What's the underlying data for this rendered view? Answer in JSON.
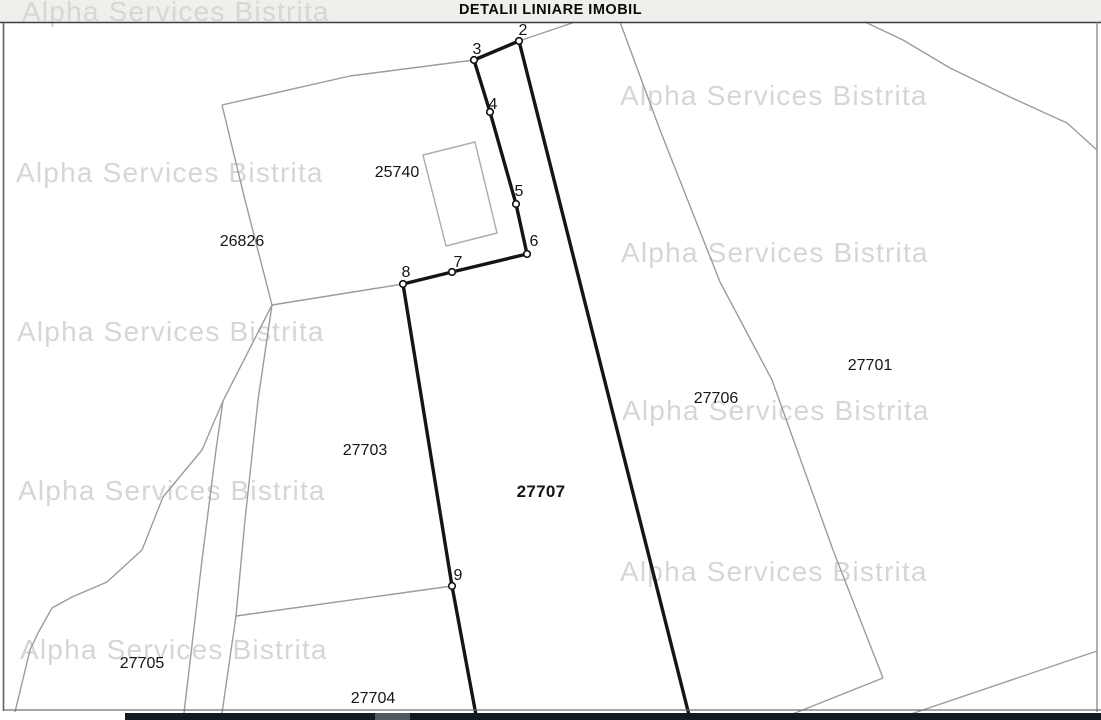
{
  "header": {
    "title": "DETALII LINIARE IMOBIL"
  },
  "watermark": {
    "text": "Alpha Services Bistrita"
  },
  "colors": {
    "header_bg": "#f1efec",
    "watermark": "#d6d6d6",
    "subject_outline": "#151515",
    "boundary": "#9c9c9c",
    "building": "#aeaeae",
    "bottom_bar": "#141a20",
    "bottom_bar_accent": "#4e5a60",
    "vertex_fill": "#ffffff",
    "vertex_stroke": "#111111",
    "label_text": "#161616"
  },
  "parcels": {
    "p25740": "25740",
    "p26826": "26826",
    "p27703": "27703",
    "p27707": "27707",
    "p27706": "27706",
    "p27701": "27701",
    "p27705": "27705",
    "p27704": "27704"
  },
  "vertices": {
    "v2": "2",
    "v3": "3",
    "v4": "4",
    "v5": "5",
    "v6": "6",
    "v7": "7",
    "v8": "8",
    "v9": "9"
  },
  "map": {
    "geometry": {
      "subject_parcel_outline": {
        "width": 3.4,
        "points": [
          [
            476,
            715
          ],
          [
            452,
            586
          ],
          [
            403,
            284
          ],
          [
            452,
            272
          ],
          [
            527,
            254
          ],
          [
            516,
            204
          ],
          [
            490,
            112
          ],
          [
            474,
            60
          ],
          [
            519,
            41
          ],
          [
            689,
            715
          ]
        ]
      },
      "boundaries": [
        {
          "name": "north-boundary-26826",
          "points": [
            [
              222,
              105
            ],
            [
              350,
              76
            ],
            [
              474,
              60
            ]
          ]
        },
        {
          "name": "west-boundary-26826",
          "points": [
            [
              222,
              105
            ],
            [
              245,
              200
            ],
            [
              272,
              305
            ]
          ]
        },
        {
          "name": "south-boundary-26826",
          "points": [
            [
              272,
              305
            ],
            [
              403,
              284
            ]
          ]
        },
        {
          "name": "junction-stem",
          "points": [
            [
              272,
              305
            ],
            [
              223,
              401
            ]
          ]
        },
        {
          "name": "west-boundary-27705",
          "points": [
            [
              223,
              401
            ],
            [
              202,
              450
            ],
            [
              163,
              497
            ],
            [
              142,
              550
            ],
            [
              107,
              582
            ],
            [
              72,
              597
            ],
            [
              52,
              608
            ],
            [
              38,
              633
            ],
            [
              30,
              650
            ],
            [
              15,
              712
            ]
          ]
        },
        {
          "name": "lane-west-line",
          "points": [
            [
              223,
              401
            ],
            [
              216,
              450
            ],
            [
              202,
              560
            ],
            [
              184,
              713
            ]
          ]
        },
        {
          "name": "lane-east-line",
          "points": [
            [
              272,
              305
            ],
            [
              258,
              400
            ],
            [
              245,
              520
            ],
            [
              236,
              616
            ],
            [
              222,
              713
            ]
          ]
        },
        {
          "name": "boundary-27703-27704",
          "points": [
            [
              236,
              616
            ],
            [
              452,
              586
            ]
          ]
        },
        {
          "name": "northeast-from-vertex2",
          "points": [
            [
              519,
              41
            ],
            [
              575,
              22
            ]
          ]
        },
        {
          "name": "boundary-27706-27701",
          "points": [
            [
              620,
              22
            ],
            [
              660,
              130
            ],
            [
              720,
              282
            ],
            [
              772,
              380
            ],
            [
              833,
              550
            ],
            [
              883,
              678
            ]
          ]
        },
        {
          "name": "south-boundary-27706",
          "points": [
            [
              883,
              678
            ],
            [
              790,
              715
            ]
          ]
        },
        {
          "name": "south-boundary-27701",
          "points": [
            [
              1097,
              651
            ],
            [
              908,
              715
            ]
          ]
        },
        {
          "name": "north-boundary-27701",
          "points": [
            [
              865,
              22
            ],
            [
              903,
              40
            ],
            [
              950,
              68
            ],
            [
              1010,
              97
            ],
            [
              1067,
              123
            ],
            [
              1097,
              150
            ]
          ]
        }
      ],
      "building_25740": {
        "points": [
          [
            423,
            155
          ],
          [
            475,
            142
          ],
          [
            497,
            233
          ],
          [
            446,
            246
          ]
        ]
      },
      "vertex_markers": [
        [
          519,
          41
        ],
        [
          474,
          60
        ],
        [
          490,
          112
        ],
        [
          516,
          204
        ],
        [
          527,
          254
        ],
        [
          452,
          272
        ],
        [
          403,
          284
        ],
        [
          452,
          586
        ]
      ],
      "frame": {
        "lines": [
          {
            "name": "top-border",
            "color": "#3f3f3f",
            "width": 1.4,
            "points": [
              [
                0,
                22.5
              ],
              [
                1101,
                22.5
              ]
            ]
          },
          {
            "name": "left-border",
            "color": "#606060",
            "width": 1.6,
            "points": [
              [
                3.5,
                22.5
              ],
              [
                3.5,
                711
              ]
            ]
          },
          {
            "name": "right-border",
            "color": "#8f8f8f",
            "width": 1.4,
            "points": [
              [
                1097,
                22.5
              ],
              [
                1097,
                712
              ]
            ]
          },
          {
            "name": "bottom-thin-border",
            "color": "#707070",
            "width": 1.2,
            "points": [
              [
                3.5,
                710
              ],
              [
                1101,
                710
              ]
            ]
          }
        ]
      },
      "bottom_bar": {
        "x": 125,
        "y": 713,
        "w": 976,
        "h": 7
      },
      "bottom_bar_accent": {
        "x": 375,
        "y": 713,
        "w": 35,
        "h": 7
      }
    }
  }
}
